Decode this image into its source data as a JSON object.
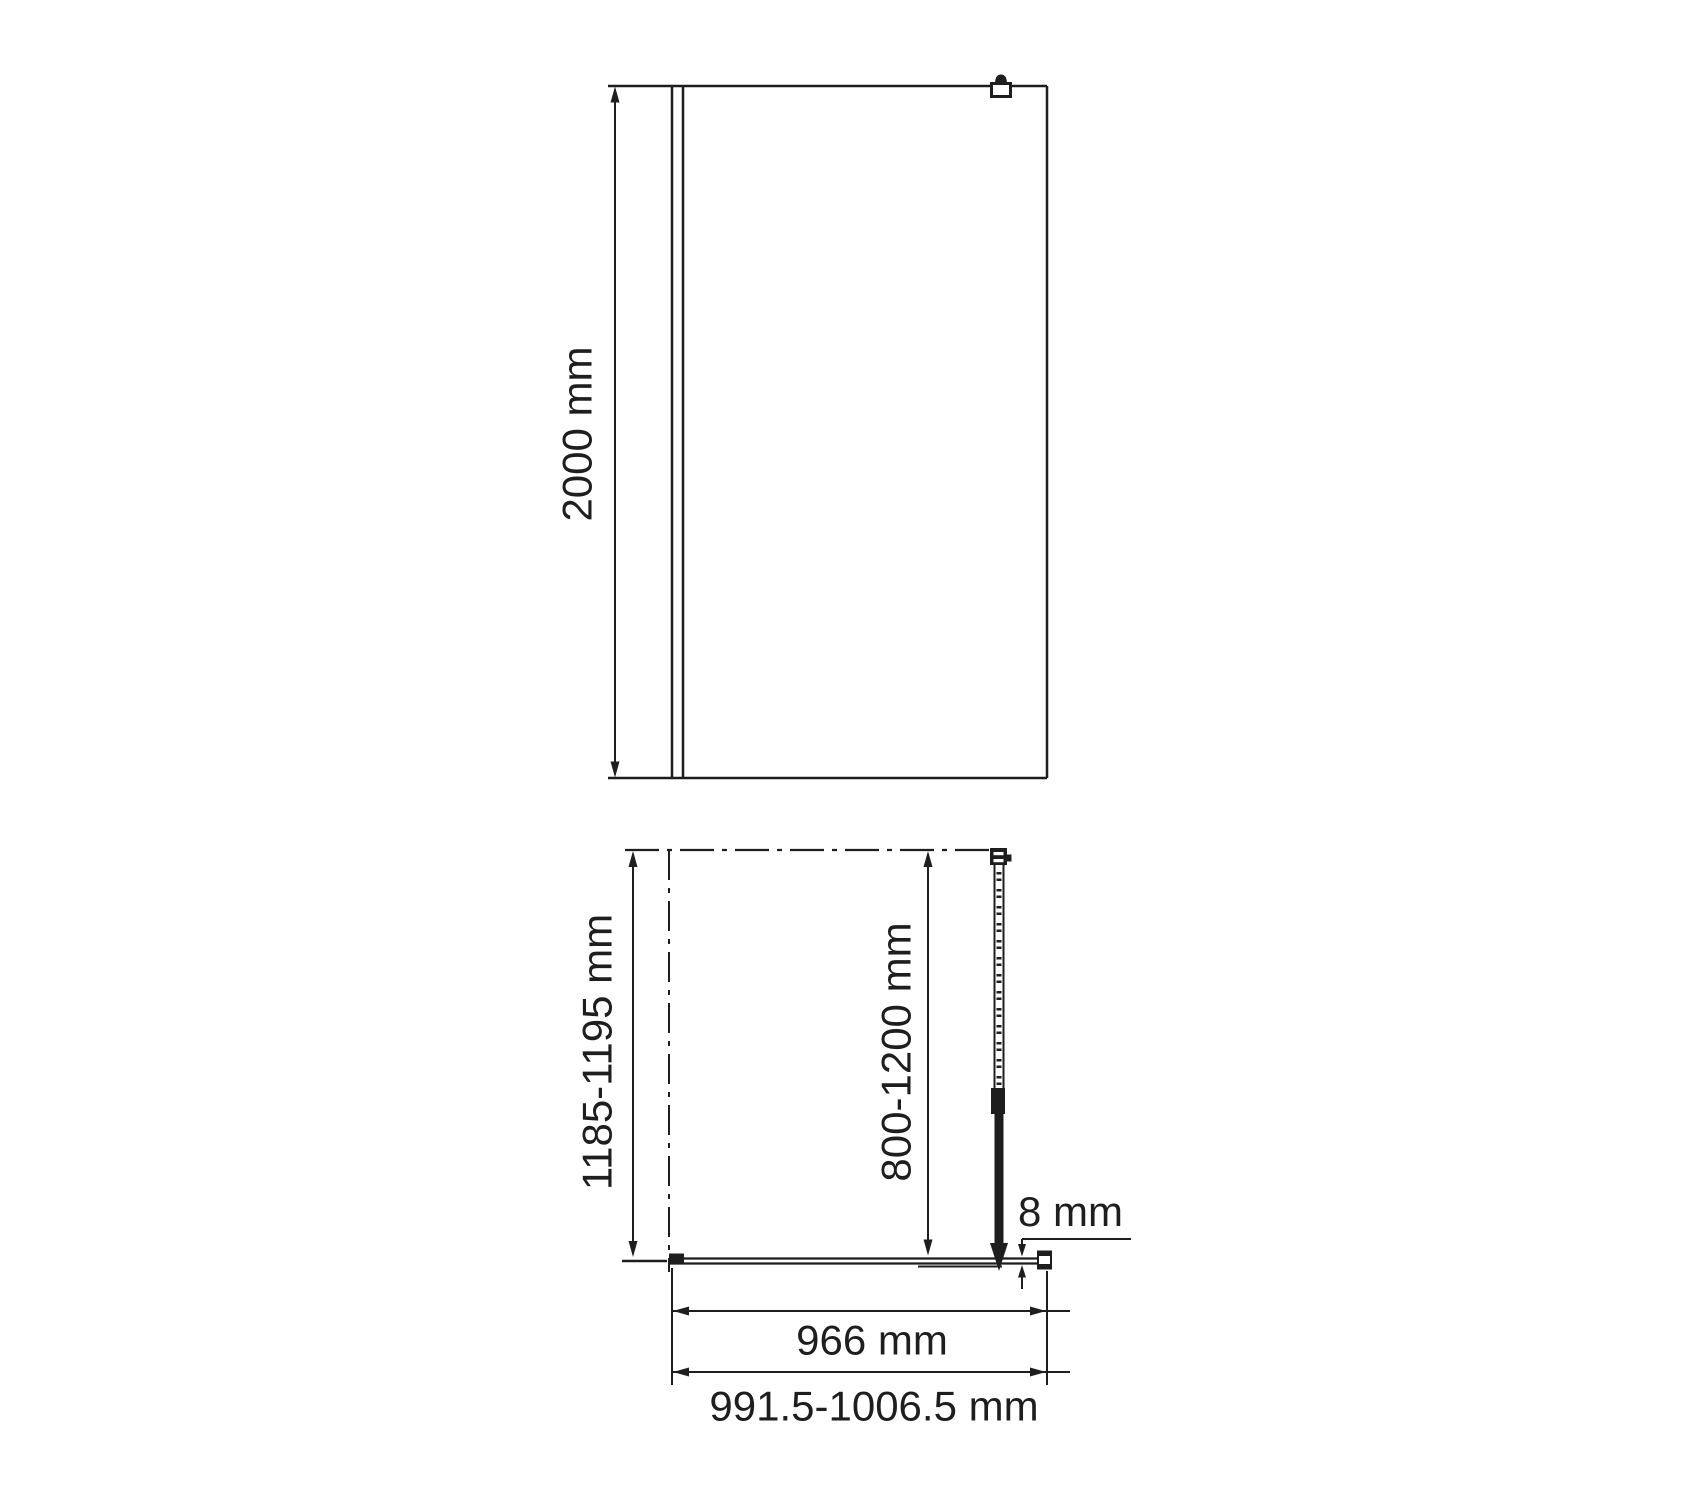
{
  "colors": {
    "ink": "#1e1e1e",
    "background": "#ffffff"
  },
  "front_view": {
    "height": "2000 mm"
  },
  "plan_view": {
    "depth": "1185-1195 mm",
    "support_bar": "800-1200 mm",
    "glass_thickness": "8 mm",
    "glass_width": "966 mm",
    "overall_width": "991.5-1006.5 mm"
  }
}
